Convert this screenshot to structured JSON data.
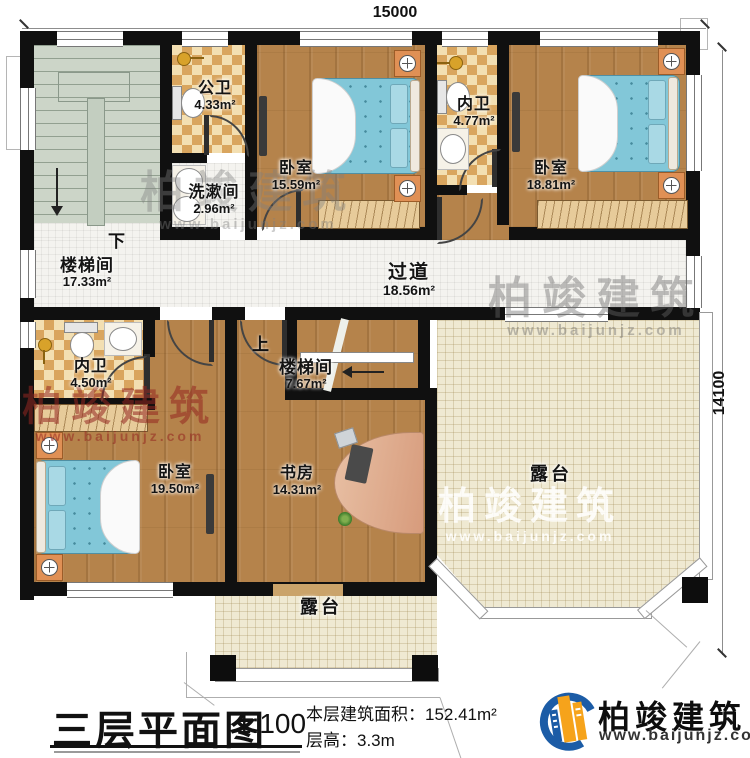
{
  "dimensions": {
    "top": "15000",
    "right": "14100"
  },
  "stairs": {
    "down_label": "下",
    "up_label": "上"
  },
  "rooms": {
    "stair_hall_main": {
      "name": "楼梯间",
      "area": "17.33m²"
    },
    "public_bath": {
      "name": "公卫",
      "area": "4.33m²"
    },
    "wash_room": {
      "name": "洗漱间",
      "area": "2.96m²"
    },
    "bedroom_top": {
      "name": "卧室",
      "area": "15.59m²"
    },
    "ensuite_top": {
      "name": "内卫",
      "area": "4.77m²"
    },
    "bedroom_right": {
      "name": "卧室",
      "area": "18.81m²"
    },
    "corridor": {
      "name": "过道",
      "area": "18.56m²"
    },
    "ensuite_left": {
      "name": "内卫",
      "area": "4.50m²"
    },
    "stair_hall_center": {
      "name": "楼梯间",
      "area": "7.67m²"
    },
    "bedroom_bottom": {
      "name": "卧室",
      "area": "19.50m²"
    },
    "study": {
      "name": "书房",
      "area": "14.31m²"
    },
    "terrace_right": {
      "name": "露台"
    },
    "terrace_bottom": {
      "name": "露台"
    }
  },
  "title_block": {
    "title": "三层平面图",
    "scale": "1:100",
    "area_line": "本层建筑面积：152.41m²",
    "height_line": "层高：3.3m"
  },
  "brand": {
    "name": "柏竣建筑",
    "url": "www.baijunjz.com"
  },
  "colors": {
    "wall": "#101010",
    "wood_floor": "#b5834b",
    "bath_checker": "#d9a55e",
    "tile_floor": "#f4f3ef",
    "terrace_floor": "#efe9d2",
    "stair_floor": "#ccd5c8",
    "bed_blue": "#82c7d8",
    "nightstand_orange": "#e09055",
    "logo_blue": "#1c5ca6",
    "logo_orange": "#f6a31b",
    "watermark_red": "#94261f"
  }
}
